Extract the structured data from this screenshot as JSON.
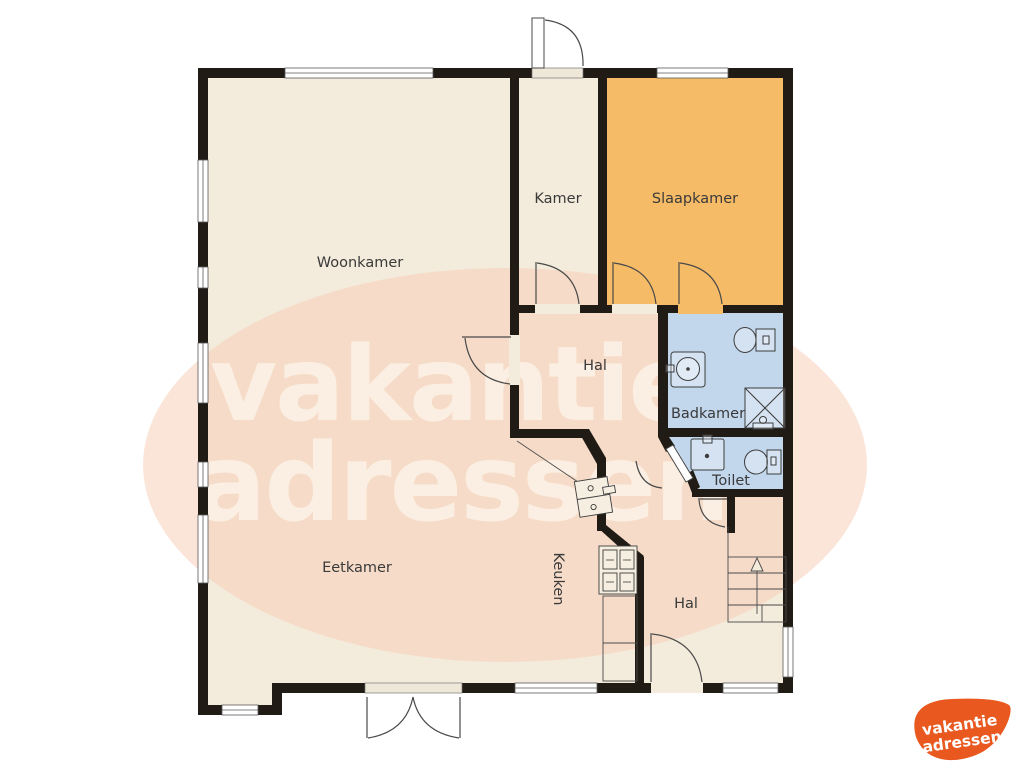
{
  "plan": {
    "rooms": {
      "woonkamer": "Woonkamer",
      "kamer": "Kamer",
      "slaapkamer": "Slaapkamer",
      "hal": "Hal",
      "badkamer": "Badkamer",
      "toilet": "Toilet",
      "eetkamer": "Eetkamer",
      "keuken": "Keuken",
      "hal2": "Hal"
    },
    "colors": {
      "floor": "#f3ebdb",
      "slaapkamer": "#f6bb66",
      "sanitary": "#c2d6ec",
      "wall": "#211b15",
      "blob": "#f7d0b8"
    }
  },
  "watermark": {
    "line1": "vakantie",
    "line2": "adressen"
  },
  "logo": {
    "line1": "vakantie",
    "line2": "adressen",
    "color": "#e8581f"
  }
}
